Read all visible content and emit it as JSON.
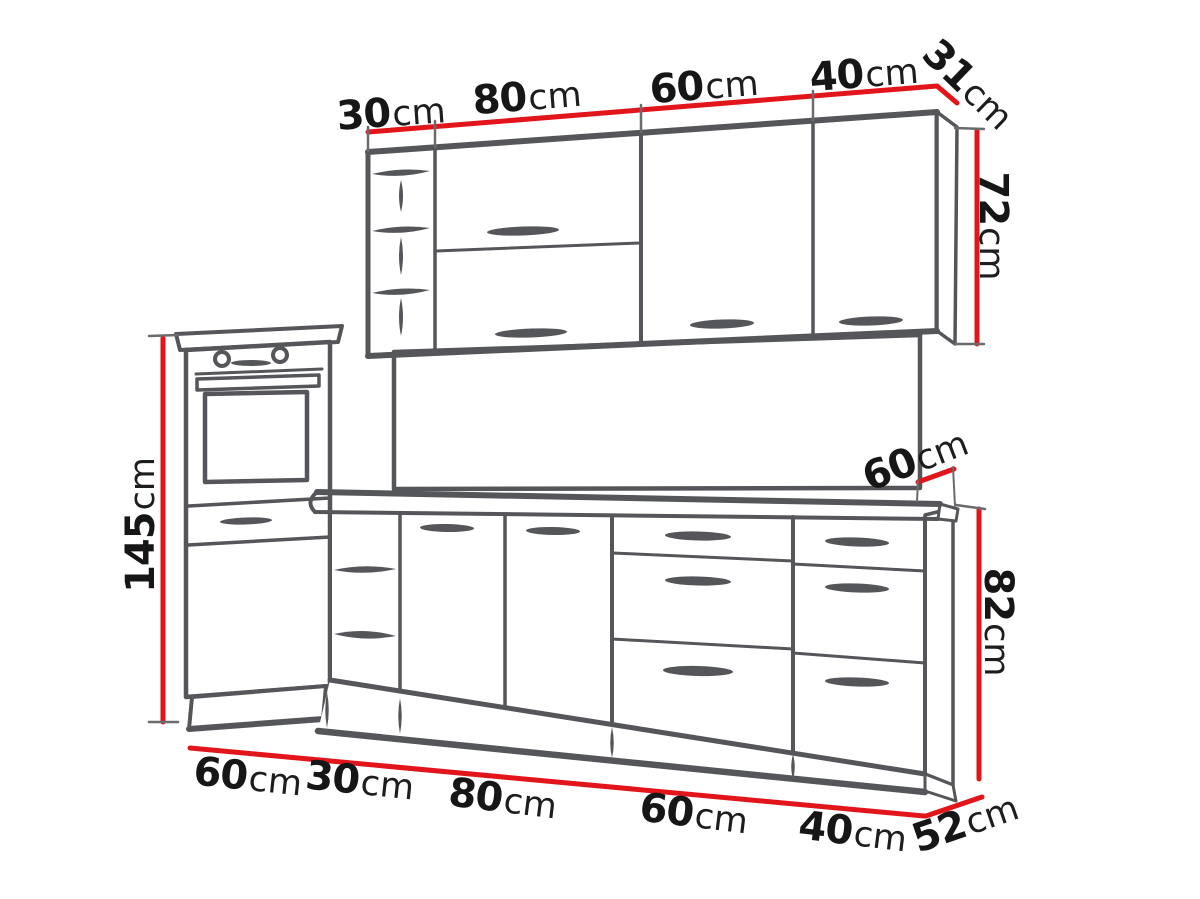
{
  "figure": {
    "kind": "kitchen-cabinet-dimension-diagram",
    "units": "cm",
    "colors": {
      "dimension_line": "#e2151b",
      "outline": "#55565a",
      "label_text": "#161616",
      "background": "#ffffff"
    }
  },
  "labels": {
    "wall_widths": [
      {
        "num": "30",
        "unit": "cm"
      },
      {
        "num": "80",
        "unit": "cm"
      },
      {
        "num": "60",
        "unit": "cm"
      },
      {
        "num": "40",
        "unit": "cm"
      }
    ],
    "wall_depth": {
      "num": "31",
      "unit": "cm"
    },
    "wall_height": {
      "num": "72",
      "unit": "cm"
    },
    "tall_height": {
      "num": "145",
      "unit": "cm"
    },
    "worktop_depth": {
      "num": "60",
      "unit": "cm"
    },
    "base_height": {
      "num": "82",
      "unit": "cm"
    },
    "base_widths": [
      {
        "num": "60",
        "unit": "cm"
      },
      {
        "num": "30",
        "unit": "cm"
      },
      {
        "num": "80",
        "unit": "cm"
      },
      {
        "num": "60",
        "unit": "cm"
      },
      {
        "num": "40",
        "unit": "cm"
      }
    ],
    "base_depth": {
      "num": "52",
      "unit": "cm"
    }
  }
}
